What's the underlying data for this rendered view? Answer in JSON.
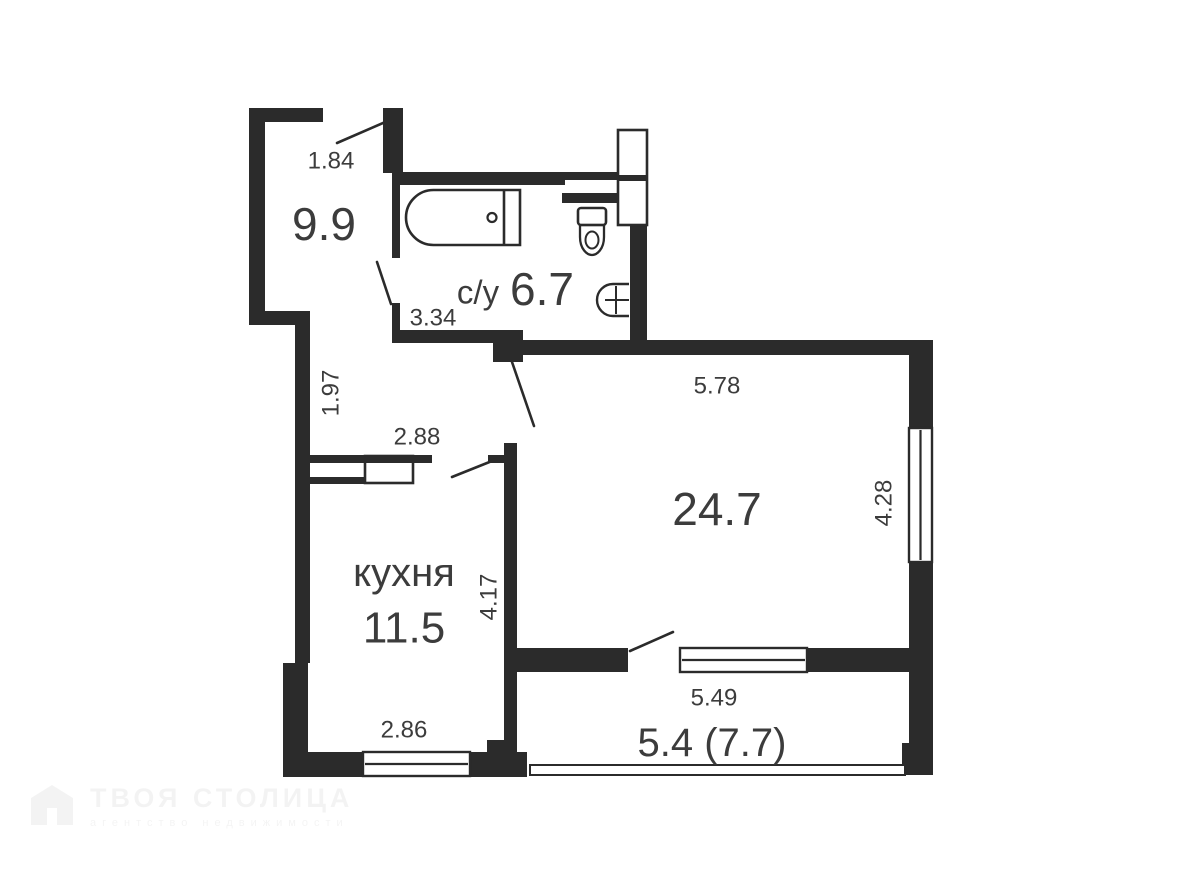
{
  "page": {
    "width": 1183,
    "height": 888,
    "background": "#ffffff"
  },
  "palette": {
    "wall": "#2b2b2b",
    "line": "#2b2b2b",
    "text": "#3c3c3c",
    "white": "#ffffff"
  },
  "plan": {
    "walls": [
      {
        "name": "hallway-top-wall",
        "x": 249,
        "y": 108,
        "w": 74,
        "h": 14
      },
      {
        "name": "entrance-right-stub",
        "x": 383,
        "y": 108,
        "w": 20,
        "h": 65
      },
      {
        "name": "hallway-left-wall",
        "x": 249,
        "y": 108,
        "w": 16,
        "h": 217
      },
      {
        "name": "hallway-bottom-jog",
        "x": 249,
        "y": 311,
        "w": 61,
        "h": 14
      },
      {
        "name": "corridor-left-wall",
        "x": 295,
        "y": 323,
        "w": 15,
        "h": 340
      },
      {
        "name": "kitchen-left-pilaster",
        "x": 283,
        "y": 663,
        "w": 25,
        "h": 114
      },
      {
        "name": "kitchen-bottom-wall",
        "x": 283,
        "y": 752,
        "w": 242,
        "h": 25
      },
      {
        "name": "bathroom-top-wall",
        "x": 392,
        "y": 172,
        "w": 173,
        "h": 13
      },
      {
        "name": "bathroom-duct-top-line",
        "x": 562,
        "y": 172,
        "w": 58,
        "h": 8
      },
      {
        "name": "bathroom-duct-bottom-line",
        "x": 562,
        "y": 193,
        "w": 60,
        "h": 10
      },
      {
        "name": "bathroom-left-wall",
        "x": 392,
        "y": 173,
        "w": 8,
        "h": 85
      },
      {
        "name": "bathroom-left-stub",
        "x": 392,
        "y": 303,
        "w": 8,
        "h": 29
      },
      {
        "name": "bathroom-bottom-wall",
        "x": 392,
        "y": 330,
        "w": 131,
        "h": 13
      },
      {
        "name": "entry-corner-block",
        "x": 493,
        "y": 330,
        "w": 30,
        "h": 32
      },
      {
        "name": "living-top-wall",
        "x": 513,
        "y": 340,
        "w": 420,
        "h": 15
      },
      {
        "name": "living-right-wall-upper",
        "x": 909,
        "y": 340,
        "w": 24,
        "h": 88
      },
      {
        "name": "living-right-wall-lower",
        "x": 909,
        "y": 562,
        "w": 24,
        "h": 213
      },
      {
        "name": "balcony-right-foot-block",
        "x": 902,
        "y": 743,
        "w": 31,
        "h": 32
      },
      {
        "name": "bathroom-right-wall",
        "x": 630,
        "y": 222,
        "w": 17,
        "h": 123
      },
      {
        "name": "kitchen-living-wall",
        "x": 504,
        "y": 443,
        "w": 13,
        "h": 334
      },
      {
        "name": "kitchen-door-notch",
        "x": 488,
        "y": 455,
        "w": 17,
        "h": 8
      },
      {
        "name": "kitchen-duct-bottom-line",
        "x": 308,
        "y": 477,
        "w": 59,
        "h": 7
      },
      {
        "name": "living-bottom-wall-left",
        "x": 513,
        "y": 648,
        "w": 115,
        "h": 24
      },
      {
        "name": "living-bottom-wall-right",
        "x": 807,
        "y": 648,
        "w": 103,
        "h": 24
      },
      {
        "name": "kitchen-bottom-right-block",
        "x": 487,
        "y": 740,
        "w": 26,
        "h": 37
      },
      {
        "name": "balcony-left-block",
        "x": 513,
        "y": 752,
        "w": 14,
        "h": 25
      }
    ],
    "white_boxes": [
      {
        "name": "vent-shaft-box",
        "x": 618,
        "y": 130,
        "w": 29,
        "h": 95
      },
      {
        "name": "kitchen-vent-box",
        "x": 365,
        "y": 456,
        "w": 48,
        "h": 27
      }
    ],
    "overlays": [
      {
        "name": "kitchen-top-wall",
        "x": 308,
        "y": 455,
        "w": 124,
        "h": 8
      },
      {
        "name": "vent-shaft-divider",
        "x": 618,
        "y": 175,
        "w": 29,
        "h": 6
      }
    ],
    "windows": [
      {
        "name": "living-room-window",
        "x": 909,
        "y": 428,
        "w": 23,
        "h": 134,
        "dir": "v"
      },
      {
        "name": "balcony-window",
        "x": 680,
        "y": 648,
        "w": 127,
        "h": 24,
        "dir": "h"
      },
      {
        "name": "kitchen-window",
        "x": 363,
        "y": 752,
        "w": 107,
        "h": 24,
        "dir": "h"
      }
    ],
    "railings": [
      {
        "name": "balcony-railing",
        "x": 530,
        "y": 765,
        "w": 375,
        "h": 10
      }
    ],
    "doors": [
      {
        "name": "entrance-door-swing",
        "x1": 383,
        "y1": 123,
        "x2": 337,
        "y2": 143
      },
      {
        "name": "bathroom-door-swing",
        "x1": 391,
        "y1": 304,
        "x2": 377,
        "y2": 262
      },
      {
        "name": "living-room-door-swing",
        "x1": 512,
        "y1": 362,
        "x2": 534,
        "y2": 426
      },
      {
        "name": "kitchen-door-swing",
        "x1": 497,
        "y1": 459,
        "x2": 452,
        "y2": 477
      },
      {
        "name": "balcony-door-swing",
        "x1": 630,
        "y1": 651,
        "x2": 673,
        "y2": 632
      }
    ],
    "fixtures": [
      {
        "type": "bathtub",
        "name": "bathtub-icon",
        "box": [
          406,
          190,
          114,
          55
        ],
        "divider_x": 504,
        "faucet": [
          492,
          217.5,
          4.5
        ]
      },
      {
        "type": "toilet",
        "name": "toilet-icon",
        "tank": [
          578,
          208,
          28,
          17
        ],
        "bowl_h": 30
      },
      {
        "type": "sink",
        "name": "sink-icon",
        "box": [
          597,
          284,
          32,
          32
        ]
      }
    ],
    "labels": [
      {
        "name": "hallway-dim-width",
        "text": "1.84",
        "x": 331,
        "y": 161,
        "size": 24
      },
      {
        "name": "hallway-area",
        "text": "9.9",
        "x": 324,
        "y": 224,
        "size": 46
      },
      {
        "name": "bathroom-name",
        "text": "с/у",
        "x": 478,
        "y": 292,
        "size": 33
      },
      {
        "name": "bathroom-area",
        "text": "6.7",
        "x": 542,
        "y": 289,
        "size": 46
      },
      {
        "name": "bathroom-dim-width",
        "text": "3.34",
        "x": 433,
        "y": 318,
        "size": 24
      },
      {
        "name": "corridor-dim-height",
        "text": "1.97",
        "x": 331,
        "y": 393,
        "size": 24,
        "rotate": -90
      },
      {
        "name": "corridor-dim-width",
        "text": "2.88",
        "x": 417,
        "y": 437,
        "size": 24
      },
      {
        "name": "kitchen-name",
        "text": "кухня",
        "x": 404,
        "y": 573,
        "size": 40
      },
      {
        "name": "kitchen-area",
        "text": "11.5",
        "x": 404,
        "y": 628,
        "size": 44
      },
      {
        "name": "kitchen-dim-height",
        "text": "4.17",
        "x": 489,
        "y": 597,
        "size": 24,
        "rotate": -90
      },
      {
        "name": "kitchen-dim-width",
        "text": "2.86",
        "x": 404,
        "y": 730,
        "size": 24
      },
      {
        "name": "living-dim-width",
        "text": "5.78",
        "x": 717,
        "y": 386,
        "size": 24
      },
      {
        "name": "living-area",
        "text": "24.7",
        "x": 717,
        "y": 509,
        "size": 46
      },
      {
        "name": "living-dim-height",
        "text": "4.28",
        "x": 884,
        "y": 503,
        "size": 24,
        "rotate": -90
      },
      {
        "name": "balcony-dim-width",
        "text": "5.49",
        "x": 714,
        "y": 698,
        "size": 24
      },
      {
        "name": "balcony-area",
        "text": "5.4 (7.7)",
        "x": 712,
        "y": 743,
        "size": 40
      }
    ]
  },
  "watermark": {
    "title": "ТВОЯ СТОЛИЦА",
    "subtitle": "агентство недвижимости"
  }
}
